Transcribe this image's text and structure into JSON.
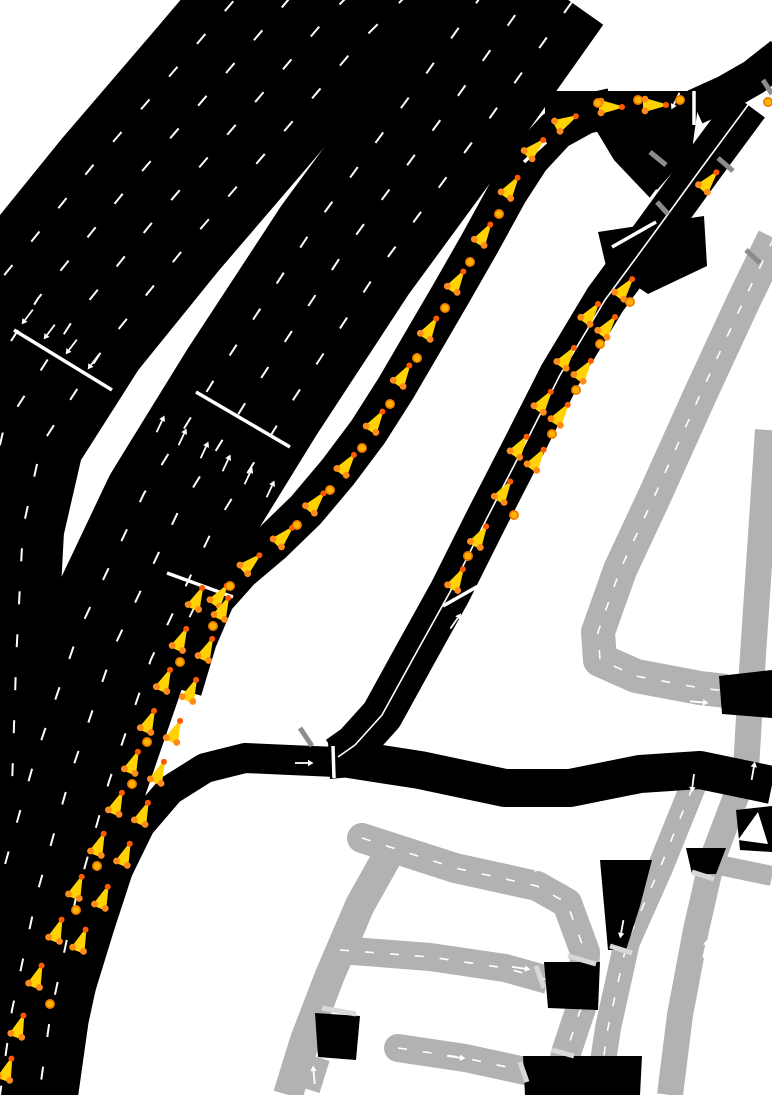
{
  "canvas": {
    "width": 772,
    "height": 1095,
    "background": "#ffffff"
  },
  "colors": {
    "road_major": "#000000",
    "road_minor": "#b2b2b2",
    "marking": "#ffffff",
    "separator": "#ffffff",
    "stop_line_dark": "#8c8c8c",
    "stop_line_light": "#d8d8d8",
    "vehicle_body": "#ffd203",
    "vehicle_nose_dot": "#ff5a00",
    "vehicle_rear_dot": "#ff8c1a",
    "small_vehicle_fill": "#ffb300",
    "small_vehicle_ring": "#f07800"
  },
  "roads": [
    {
      "id": "gray-avenue-ne",
      "class": "minor",
      "w": 34,
      "center": "dashed",
      "pts": [
        [
          774,
          238
        ],
        [
          744,
          300
        ],
        [
          700,
          395
        ],
        [
          655,
          495
        ],
        [
          620,
          570
        ],
        [
          598,
          632
        ],
        [
          600,
          660
        ],
        [
          636,
          676
        ],
        [
          700,
          688
        ],
        [
          726,
          691
        ]
      ]
    },
    {
      "id": "gray-right-edge",
      "class": "minor",
      "w": 26,
      "center": "none",
      "pts": [
        [
          768,
          430
        ],
        [
          758,
          580
        ],
        [
          750,
          700
        ],
        [
          746,
          770
        ],
        [
          712,
          860
        ],
        [
          696,
          930
        ],
        [
          680,
          1015
        ],
        [
          670,
          1095
        ]
      ]
    },
    {
      "id": "gray-vertical-mid",
      "class": "minor",
      "w": 26,
      "center": "dashed",
      "pts": [
        [
          702,
          764
        ],
        [
          660,
          868
        ],
        [
          627,
          942
        ],
        [
          608,
          1028
        ],
        [
          598,
          1095
        ]
      ]
    },
    {
      "id": "gray-loop",
      "class": "minor",
      "w": 30,
      "center": "dashed",
      "cap": "round",
      "pts": [
        [
          362,
          838
        ],
        [
          455,
          868
        ],
        [
          537,
          886
        ],
        [
          567,
          903
        ],
        [
          585,
          952
        ],
        [
          583,
          1002
        ],
        [
          567,
          1050
        ],
        [
          558,
          1088
        ]
      ]
    },
    {
      "id": "gray-diagonal",
      "class": "minor",
      "w": 30,
      "center": "none",
      "pts": [
        [
          392,
          848
        ],
        [
          360,
          905
        ],
        [
          330,
          975
        ],
        [
          305,
          1040
        ],
        [
          288,
          1095
        ]
      ]
    },
    {
      "id": "gray-street-mid",
      "class": "minor",
      "w": 28,
      "center": "dashed",
      "pts": [
        [
          340,
          950
        ],
        [
          430,
          957
        ],
        [
          505,
          968
        ],
        [
          548,
          980
        ]
      ]
    },
    {
      "id": "gray-street-low",
      "class": "minor",
      "w": 28,
      "center": "dashed",
      "cap": "round",
      "pts": [
        [
          398,
          1048
        ],
        [
          465,
          1058
        ],
        [
          530,
          1072
        ]
      ]
    },
    {
      "id": "gray-stub-right",
      "class": "minor",
      "w": 20,
      "center": "none",
      "pts": [
        [
          714,
          864
        ],
        [
          772,
          876
        ]
      ]
    },
    {
      "id": "gray-stub-low",
      "class": "minor",
      "w": 20,
      "center": "none",
      "pts": [
        [
          320,
          1058
        ],
        [
          310,
          1090
        ]
      ]
    },
    {
      "id": "freeway-southbound",
      "class": "major",
      "w": 205,
      "lanes": 5,
      "pts": [
        [
          395,
          -80
        ],
        [
          315,
          0
        ],
        [
          230,
          100
        ],
        [
          140,
          205
        ],
        [
          55,
          310
        ],
        [
          -15,
          420
        ],
        [
          -38,
          520
        ],
        [
          -45,
          650
        ],
        [
          -50,
          800
        ]
      ]
    },
    {
      "id": "freeway-northbound",
      "class": "major",
      "w": 155,
      "lanes": 4,
      "pts": [
        [
          540,
          -20
        ],
        [
          455,
          100
        ],
        [
          345,
          250
        ],
        [
          252,
          392
        ],
        [
          178,
          512
        ],
        [
          115,
          645
        ],
        [
          72,
          770
        ],
        [
          38,
          890
        ],
        [
          12,
          1010
        ],
        [
          0,
          1095
        ]
      ]
    },
    {
      "id": "onramp",
      "class": "major",
      "w": 40,
      "pts": [
        [
          612,
          108
        ],
        [
          585,
          114
        ],
        [
          556,
          130
        ],
        [
          530,
          158
        ],
        [
          508,
          192
        ],
        [
          480,
          243
        ],
        [
          452,
          292
        ],
        [
          424,
          340
        ],
        [
          396,
          388
        ],
        [
          368,
          432
        ],
        [
          338,
          472
        ],
        [
          306,
          510
        ],
        [
          272,
          543
        ],
        [
          240,
          570
        ],
        [
          215,
          598
        ],
        [
          197,
          640
        ],
        [
          182,
          690
        ]
      ]
    },
    {
      "id": "road-top",
      "class": "major",
      "w": 34,
      "pts": [
        [
          545,
          108
        ],
        [
          694,
          108
        ]
      ]
    },
    {
      "id": "road-topright",
      "class": "major",
      "w": 36,
      "pts": [
        [
          695,
          107
        ],
        [
          726,
          93
        ],
        [
          754,
          77
        ],
        [
          782,
          55
        ]
      ]
    },
    {
      "id": "road-diagonal",
      "class": "major",
      "w": 42,
      "center": "solid",
      "pts": [
        [
          748,
          105
        ],
        [
          700,
          170
        ],
        [
          655,
          232
        ],
        [
          605,
          300
        ],
        [
          560,
          375
        ],
        [
          522,
          450
        ],
        [
          486,
          520
        ],
        [
          450,
          592
        ],
        [
          415,
          655
        ],
        [
          382,
          715
        ],
        [
          355,
          745
        ],
        [
          338,
          757
        ]
      ]
    },
    {
      "id": "road-east",
      "class": "major",
      "w": 38,
      "pts": [
        [
          336,
          757
        ],
        [
          420,
          770
        ],
        [
          505,
          788
        ],
        [
          570,
          788
        ],
        [
          640,
          774
        ],
        [
          700,
          770
        ],
        [
          772,
          785
        ]
      ]
    },
    {
      "id": "road-west-curve",
      "class": "major",
      "w": 30,
      "pts": [
        [
          336,
          762
        ],
        [
          290,
          760
        ],
        [
          245,
          758
        ],
        [
          205,
          768
        ],
        [
          170,
          790
        ],
        [
          140,
          825
        ],
        [
          118,
          870
        ],
        [
          100,
          925
        ],
        [
          80,
          990
        ],
        [
          60,
          1050
        ],
        [
          45,
          1095
        ]
      ]
    }
  ],
  "junction_patches": [
    {
      "id": "junction-top-triangle",
      "pts": [
        [
          596,
          94
        ],
        [
          700,
          92
        ],
        [
          692,
          150
        ],
        [
          650,
          198
        ],
        [
          614,
          160
        ],
        [
          590,
          120
        ]
      ]
    },
    {
      "id": "junction-diagonal-mid",
      "pts": [
        [
          598,
          232
        ],
        [
          704,
          216
        ],
        [
          707,
          266
        ],
        [
          648,
          294
        ],
        [
          606,
          266
        ]
      ]
    },
    {
      "id": "junction-right-edge",
      "pts": [
        [
          719,
          676
        ],
        [
          772,
          670
        ],
        [
          772,
          718
        ],
        [
          722,
          714
        ]
      ]
    },
    {
      "id": "junction-stub-right",
      "pts": [
        [
          736,
          810
        ],
        [
          772,
          806
        ],
        [
          772,
          852
        ],
        [
          740,
          850
        ]
      ]
    },
    {
      "id": "junction-fan",
      "pts": [
        [
          600,
          860
        ],
        [
          652,
          860
        ],
        [
          640,
          906
        ],
        [
          626,
          950
        ],
        [
          608,
          950
        ],
        [
          604,
          905
        ]
      ]
    },
    {
      "id": "junction-v3-top",
      "pts": [
        [
          686,
          848
        ],
        [
          726,
          848
        ],
        [
          716,
          874
        ],
        [
          692,
          874
        ]
      ]
    },
    {
      "id": "junction-grid-mid",
      "pts": [
        [
          544,
          962
        ],
        [
          600,
          962
        ],
        [
          598,
          1010
        ],
        [
          548,
          1008
        ]
      ]
    },
    {
      "id": "junction-grid-bottom",
      "pts": [
        [
          523,
          1056
        ],
        [
          642,
          1056
        ],
        [
          640,
          1095
        ],
        [
          525,
          1095
        ]
      ]
    },
    {
      "id": "junction-diag-low",
      "pts": [
        [
          315,
          1013
        ],
        [
          360,
          1016
        ],
        [
          356,
          1060
        ],
        [
          318,
          1057
        ]
      ]
    },
    {
      "id": "junction-y",
      "pts": [
        [
          328,
          742
        ],
        [
          354,
          742
        ],
        [
          362,
          776
        ],
        [
          330,
          779
        ]
      ]
    }
  ],
  "separators": [
    {
      "x1": 14,
      "y1": 330,
      "x2": 112,
      "y2": 390
    },
    {
      "x1": 196,
      "y1": 392,
      "x2": 290,
      "y2": 447
    },
    {
      "x1": 167,
      "y1": 573,
      "x2": 233,
      "y2": 597
    },
    {
      "x1": 443,
      "y1": 606,
      "x2": 487,
      "y2": 581
    },
    {
      "x1": 612,
      "y1": 247,
      "x2": 656,
      "y2": 222
    },
    {
      "x1": 694,
      "y1": 91,
      "x2": 694,
      "y2": 125
    },
    {
      "x1": 333,
      "y1": 746,
      "x2": 334,
      "y2": 778
    },
    {
      "x1": 524,
      "y1": 162,
      "x2": 546,
      "y2": 142
    }
  ],
  "stop_lines": [
    {
      "x1": 650,
      "y1": 152,
      "x2": 666,
      "y2": 165,
      "tone": "dark"
    },
    {
      "x1": 718,
      "y1": 158,
      "x2": 733,
      "y2": 171,
      "tone": "dark"
    },
    {
      "x1": 657,
      "y1": 202,
      "x2": 668,
      "y2": 214,
      "tone": "dark"
    },
    {
      "x1": 300,
      "y1": 728,
      "x2": 312,
      "y2": 746,
      "tone": "dark"
    },
    {
      "x1": 763,
      "y1": 80,
      "x2": 772,
      "y2": 94,
      "tone": "dark"
    },
    {
      "x1": 746,
      "y1": 250,
      "x2": 760,
      "y2": 263,
      "tone": "dark"
    },
    {
      "x1": 568,
      "y1": 956,
      "x2": 596,
      "y2": 964,
      "tone": "light"
    },
    {
      "x1": 536,
      "y1": 966,
      "x2": 544,
      "y2": 988,
      "tone": "light"
    },
    {
      "x1": 610,
      "y1": 946,
      "x2": 632,
      "y2": 953,
      "tone": "light"
    },
    {
      "x1": 692,
      "y1": 872,
      "x2": 714,
      "y2": 879,
      "tone": "light"
    },
    {
      "x1": 520,
      "y1": 1062,
      "x2": 527,
      "y2": 1082,
      "tone": "light"
    },
    {
      "x1": 322,
      "y1": 1008,
      "x2": 356,
      "y2": 1014,
      "tone": "light"
    },
    {
      "x1": 552,
      "y1": 1050,
      "x2": 574,
      "y2": 1056,
      "tone": "light"
    }
  ],
  "arrows": [
    [
      28,
      316,
      127
    ],
    [
      50,
      331,
      127
    ],
    [
      72,
      346,
      127
    ],
    [
      94,
      361,
      127
    ],
    [
      160,
      425,
      -65
    ],
    [
      182,
      438,
      -65
    ],
    [
      204,
      451,
      -65
    ],
    [
      226,
      464,
      -65
    ],
    [
      248,
      477,
      -65
    ],
    [
      270,
      490,
      -65
    ],
    [
      193,
      610,
      -64
    ],
    [
      455,
      622,
      -55
    ],
    [
      652,
      196,
      127
    ],
    [
      676,
      100,
      116
    ],
    [
      303,
      763,
      0
    ],
    [
      698,
      702,
      5
    ],
    [
      693,
      782,
      97
    ],
    [
      622,
      928,
      100
    ],
    [
      753,
      772,
      -80
    ],
    [
      705,
      950,
      -78
    ],
    [
      520,
      968,
      8
    ],
    [
      530,
      868,
      10
    ],
    [
      455,
      1057,
      8
    ],
    [
      314,
      1076,
      -95
    ]
  ],
  "fat_arrow": {
    "pts": [
      [
        738,
        840
      ],
      [
        758,
        812
      ],
      [
        768,
        844
      ]
    ]
  },
  "vehicles": [
    [
      612,
      107,
      0
    ],
    [
      656,
      105,
      0
    ],
    [
      567,
      121,
      -28
    ],
    [
      536,
      147,
      -44
    ],
    [
      512,
      186,
      -56
    ],
    [
      485,
      233,
      -58
    ],
    [
      458,
      280,
      -58
    ],
    [
      431,
      327,
      -58
    ],
    [
      404,
      374,
      -58
    ],
    [
      377,
      420,
      -57
    ],
    [
      348,
      463,
      -54
    ],
    [
      317,
      501,
      -50
    ],
    [
      285,
      535,
      -46
    ],
    [
      252,
      562,
      -42
    ],
    [
      221,
      594,
      -55
    ],
    [
      224,
      607,
      -65
    ],
    [
      198,
      597,
      -65
    ],
    [
      208,
      648,
      -65
    ],
    [
      182,
      638,
      -65
    ],
    [
      192,
      689,
      -66
    ],
    [
      166,
      679,
      -66
    ],
    [
      176,
      730,
      -66
    ],
    [
      150,
      720,
      -66
    ],
    [
      160,
      771,
      -67
    ],
    [
      134,
      761,
      -67
    ],
    [
      144,
      812,
      -67
    ],
    [
      118,
      802,
      -67
    ],
    [
      126,
      853,
      -68
    ],
    [
      100,
      843,
      -68
    ],
    [
      104,
      896,
      -68
    ],
    [
      78,
      886,
      -68
    ],
    [
      82,
      939,
      -69
    ],
    [
      58,
      929,
      -69
    ],
    [
      38,
      975,
      -69
    ],
    [
      20,
      1025,
      -70
    ],
    [
      8,
      1068,
      -70
    ],
    [
      592,
      312,
      -53
    ],
    [
      609,
      325,
      -53
    ],
    [
      568,
      356,
      -54
    ],
    [
      585,
      369,
      -54
    ],
    [
      545,
      400,
      -55
    ],
    [
      562,
      413,
      -55
    ],
    [
      521,
      445,
      -56
    ],
    [
      538,
      458,
      -56
    ],
    [
      505,
      490,
      -58
    ],
    [
      481,
      535,
      -59
    ],
    [
      458,
      578,
      -61
    ],
    [
      626,
      287,
      -52
    ],
    [
      710,
      180,
      -50
    ]
  ],
  "small_vehicles": [
    [
      598,
      103
    ],
    [
      638,
      100
    ],
    [
      680,
      100
    ],
    [
      768,
      102
    ],
    [
      499,
      214
    ],
    [
      470,
      262
    ],
    [
      445,
      308
    ],
    [
      417,
      358
    ],
    [
      390,
      404
    ],
    [
      362,
      448
    ],
    [
      330,
      490
    ],
    [
      297,
      525
    ],
    [
      230,
      586
    ],
    [
      213,
      626
    ],
    [
      180,
      662
    ],
    [
      147,
      742
    ],
    [
      132,
      784
    ],
    [
      97,
      866
    ],
    [
      76,
      910
    ],
    [
      50,
      1004
    ],
    [
      600,
      344
    ],
    [
      576,
      390
    ],
    [
      552,
      434
    ],
    [
      630,
      302
    ],
    [
      514,
      515
    ],
    [
      468,
      556
    ]
  ]
}
